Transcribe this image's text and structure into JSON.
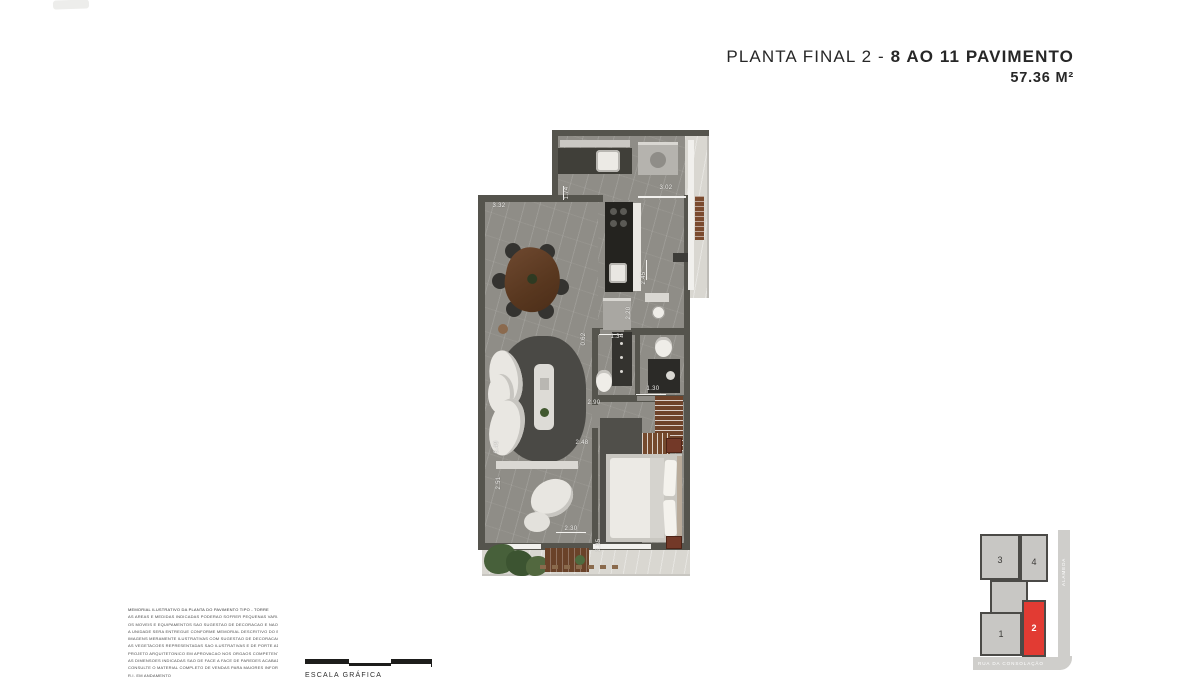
{
  "document": {
    "title": {
      "prefix": "PLANTA FINAL 2 - ",
      "emphasis": "8 AO 11 PAVIMENTO",
      "area": "57.36 M²"
    }
  },
  "floorplan": {
    "dimensions": [
      "3.32",
      "1.74",
      "3.02",
      "2.45",
      "2.20",
      "0.62",
      "1.34",
      "2.90",
      "1.30",
      "2.48",
      "6.49",
      "2.51",
      "2.30",
      "2.35"
    ]
  },
  "scale": {
    "label": "ESCALA GRÁFICA"
  },
  "keyplan": {
    "units": [
      {
        "number": "1",
        "highlighted": false
      },
      {
        "number": "2",
        "highlighted": true
      },
      {
        "number": "3",
        "highlighted": false
      },
      {
        "number": "4",
        "highlighted": false
      }
    ],
    "streets": {
      "bottom": "RUA DA CONSOLAÇÃO",
      "right": "ALAMEDA"
    },
    "colors": {
      "highlight": "#e23b33",
      "block": "#c8c7c4",
      "street": "#cfcecb"
    }
  },
  "disclaimer": {
    "lines": [
      "MEMORIAL ILUSTRATIVO DA PLANTA DO PAVIMENTO TIPO - TORRE",
      "AS AREAS E MEDIDAS INDICADAS PODERAO SOFRER PEQUENAS VARIACOES NA OBRA",
      "OS MOVEIS E EQUIPAMENTOS SAO SUGESTAO DE DECORACAO E NAO INTEGRAM O IMOVEL",
      "A UNIDADE SERA ENTREGUE CONFORME MEMORIAL DESCRITIVO DO EMPREENDIMENTO",
      "IMAGENS MERAMENTE ILUSTRATIVAS COM SUGESTAO DE DECORACAO",
      "AS VEGETACOES REPRESENTADAS SAO ILUSTRATIVAS E DE PORTE ADULTO",
      "PROJETO ARQUITETONICO EM APROVACAO NOS ORGAOS COMPETENTES",
      "AS DIMENSOES INDICADAS SAO DE FACE A FACE DE PAREDES ACABADAS",
      "CONSULTE O MATERIAL COMPLETO DE VENDAS PARA MAIORES INFORMACOES",
      "R.I. EM ANDAMENTO"
    ]
  }
}
